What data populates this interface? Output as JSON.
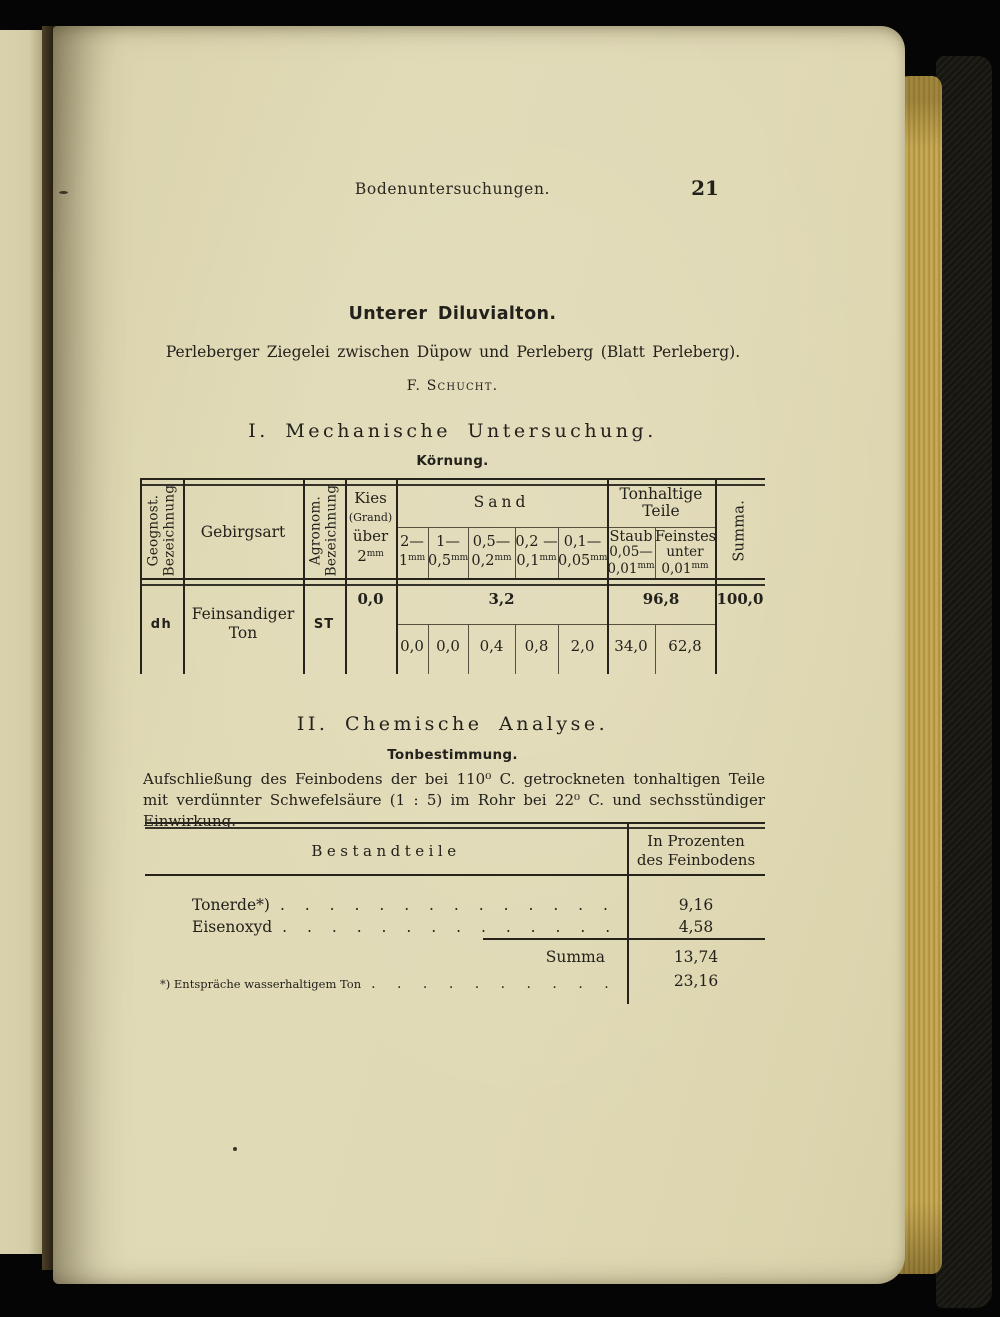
{
  "colors": {
    "paper": "#dfd9b6",
    "ink": "#23211b",
    "page_edge_gold": "#c2a44d",
    "cover": "#16150f"
  },
  "page": {
    "running_header": "Bodenuntersuchungen.",
    "page_number": "21",
    "title": "Unterer Diluvialton.",
    "subtitle": "Perleberger Ziegelei zwischen Düpow und Perleberg (Blatt Perleberg).",
    "author": "F. Schucht."
  },
  "section1": {
    "heading": "I. Mechanische Untersuchung.",
    "subheading": "Körnung."
  },
  "table1": {
    "headers": {
      "geognost": {
        "line1": "Geognost.",
        "line2": "Bezeichnung"
      },
      "gebirgsart": "Gebirgsart",
      "agronom": {
        "line1": "Agronom.",
        "line2": "Bezeichnung"
      },
      "kies": {
        "line1": "Kies",
        "line2": "(Grand)",
        "line3": "über",
        "v": "2",
        "u": "mm"
      },
      "sand_group": "Sand",
      "sand_cols": [
        {
          "top": "2—",
          "v": "1",
          "u": "mm"
        },
        {
          "top": "1—",
          "v": "0,5",
          "u": "mm"
        },
        {
          "top": "0,5—",
          "v": "0,2",
          "u": "mm"
        },
        {
          "top": "0,2 —",
          "v": "0,1",
          "u": "mm"
        },
        {
          "top": "0,1—",
          "v": "0,05",
          "u": "mm"
        }
      ],
      "ton_group": {
        "line1": "Tonhaltige",
        "line2": "Teile"
      },
      "staub": {
        "line1": "Staub",
        "line2": "0,05—",
        "v": "0,01",
        "u": "mm"
      },
      "feinstes": {
        "line1": "Feinstes",
        "line2": "unter",
        "v": "0,01",
        "u": "mm"
      },
      "summa": "Summa."
    },
    "row": {
      "geognost": "dh",
      "gebirgsart_line1": "Feinsandiger",
      "gebirgsart_line2": "Ton",
      "agronom": "ST",
      "kies": "0,0",
      "sand_total": "3,2",
      "sand_values": [
        "0,0",
        "0,0",
        "0,4",
        "0,8",
        "2,0"
      ],
      "ton_total": "96,8",
      "ton_values": [
        "34,0",
        "62,8"
      ],
      "summa": "100,0"
    }
  },
  "section2": {
    "heading": "II. Chemische Analyse.",
    "subheading": "Tonbestimmung.",
    "paragraph": "Aufschließung des Feinbodens der bei 110⁰ C. getrockneten tonhaltigen Teile mit verdünnter Schwefelsäure (1 : 5) im Rohr bei 22⁰ C. und sechsstündiger Einwirkung."
  },
  "table2": {
    "header_left": "Bestandteile",
    "header_right_line1": "In Prozenten",
    "header_right_line2": "des Feinbodens",
    "rows": [
      {
        "label": "Tonerde*)",
        "value": "9,16"
      },
      {
        "label": "Eisenoxyd",
        "value": "4,58"
      }
    ],
    "summa_label": "Summa",
    "summa_value": "13,74",
    "footnote_label": "*) Entspräche wasserhaltigem Ton",
    "footnote_value": "23,16",
    "dots": ". . . . . . . . . . . . . . . . . . . . . . . . . . . . . . . . . . ."
  }
}
